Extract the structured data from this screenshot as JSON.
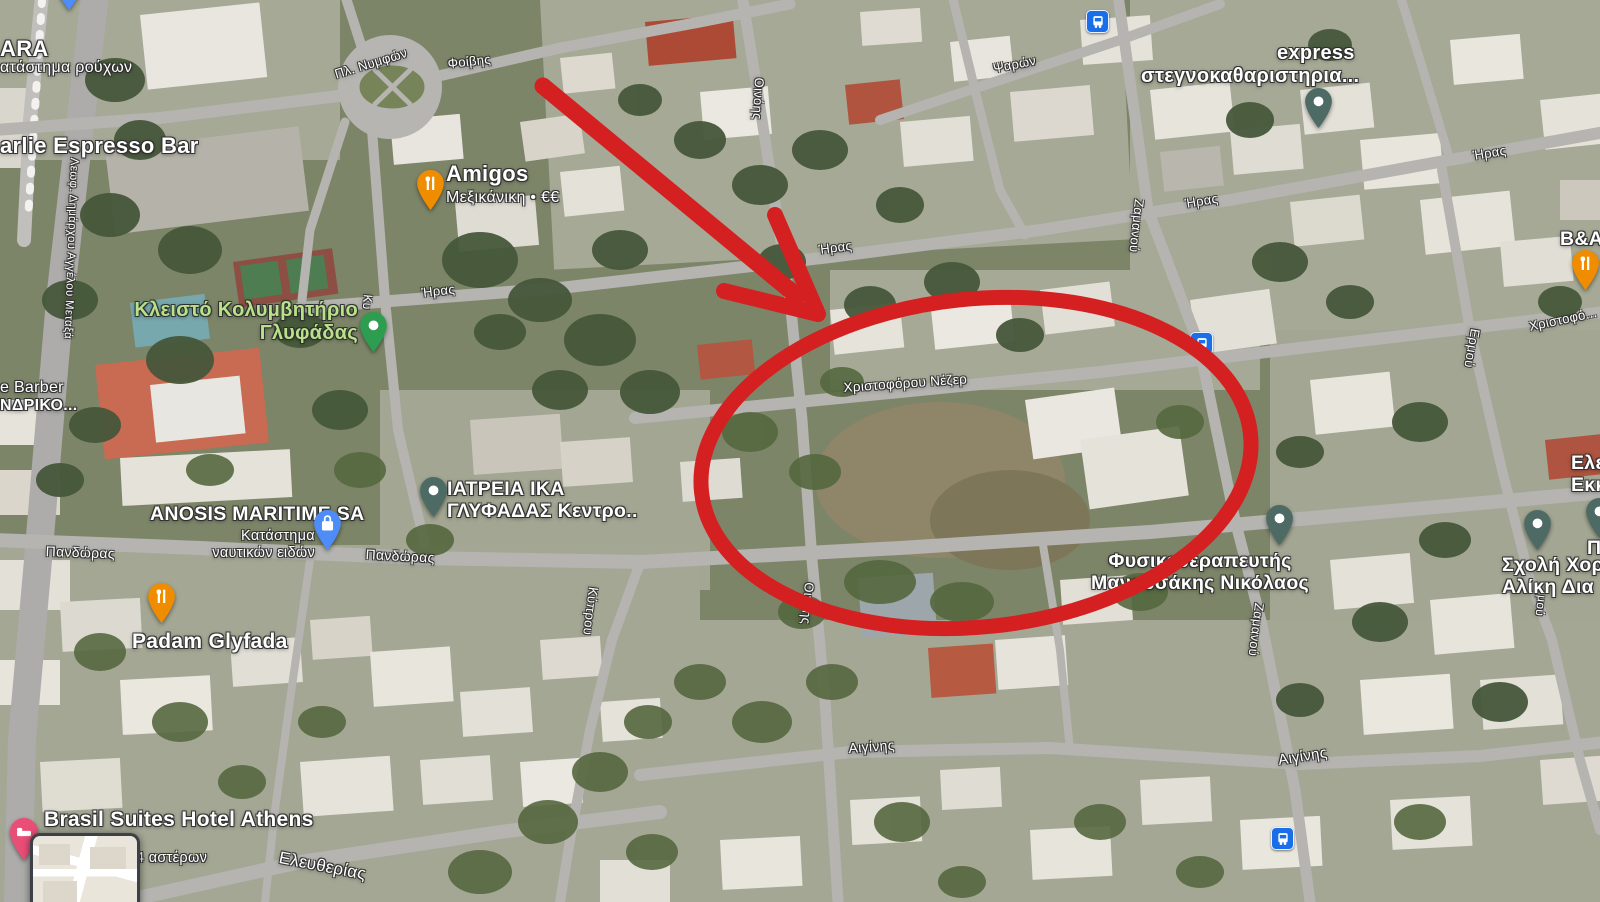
{
  "map": {
    "pois": {
      "zara": {
        "name": "ARA",
        "sub": "ατάστημα ρούχων"
      },
      "espresso": {
        "name": "arlie Espresso Bar"
      },
      "amigos": {
        "name": "Amigos",
        "sub": "Μεξικάνικη • €€"
      },
      "pool": {
        "line1": "Κλειστό Κολυμβητήριο",
        "line2": "Γλυφάδας"
      },
      "barber": {
        "line1": "e Barber",
        "line2": "ΝΔΡΙΚΟ..."
      },
      "anosis": {
        "name": "ANOSIS MARITIME SA",
        "sub1": "Κατάστημα",
        "sub2": "ναυτικών ειδών"
      },
      "iatreia": {
        "line1": "ΙΑΤΡΕΙΑ ΙΚΑ",
        "line2": "ΓΛΥΦΑΔΑΣ Κεντρο.."
      },
      "padam": {
        "name": "Padam Glyfada"
      },
      "express": {
        "line1": "express",
        "line2": "στεγνοκαθαριστηρια..."
      },
      "ba": {
        "name": "B&A"
      },
      "physio": {
        "line1": "Φυσικοθεραπευτής",
        "line2": "Μανουσάκης Νικόλαος"
      },
      "dance": {
        "line1": "Σχολή Χορ",
        "line2": "Αλίκη Δια"
      },
      "church": {
        "line1": "Ελε",
        "line2": "Εκκ"
      },
      "partial_pi": "Π",
      "brasil": {
        "name": "Brasil Suites Hotel Athens",
        "sub": "4 αστέρων"
      }
    },
    "streets": {
      "pl_nymfon": "Πλ. Νυμφών",
      "foivis": "Φοίβης",
      "iras": "Ήρας",
      "psaron": "Ψαρών",
      "oinois": "Οινόης",
      "zamanou": "Ζαμανού",
      "ermou": "Ερμού",
      "christoforou": "Χριστοφό...",
      "nezer": "Χριστοφόρου Νέζερ",
      "pandoras": "Πανδώρας",
      "kyprou": "Κύπρου",
      "kyprou_part": "Κυ",
      "aiginis": "Αιγίνης",
      "eleftherias": "Ελευθερίας",
      "metaxa": "Λεωφ. Δημάρχου Αγγέλου Μεταξά",
      "mou_partial": "μού"
    },
    "pin_colors": {
      "restaurant": "#F08C00",
      "shopping": "#4e8df7",
      "place": "#4d6b64",
      "pool": "#2d9e4f",
      "hotel": "#E94E77",
      "bus": "#1a6fe8"
    }
  },
  "annotations": {
    "color": "#d42020",
    "arrow": {
      "from_x": 543,
      "from_y": 86,
      "to_x": 818,
      "to_y": 314
    },
    "ellipse": {
      "cx": 976,
      "cy": 463,
      "rx": 276,
      "ry": 164,
      "rotation_deg": -6
    }
  }
}
